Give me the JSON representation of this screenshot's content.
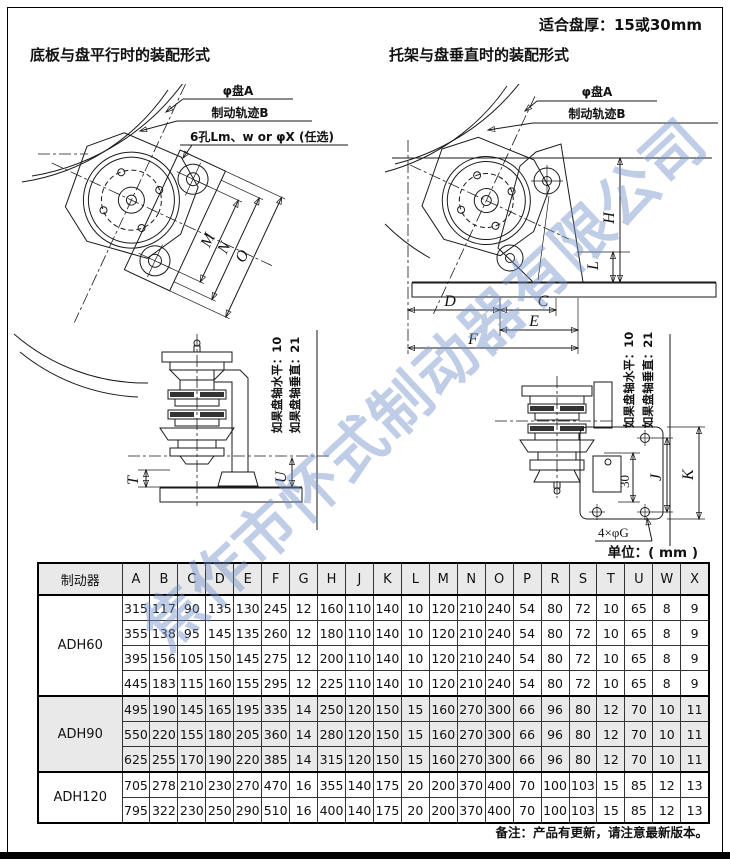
{
  "page": {
    "disc_note": "适合盘厚：15或30mm",
    "watermark": "焦作市怀式制动器有限公司",
    "unit_note": "单位：( mm )",
    "footer_note": "备注：产品有更新，请注意最新版本。"
  },
  "left_section": {
    "title": "底板与盘平行时的装配形式",
    "disc_label": "φ盘A",
    "track_label": "制动轨迹B",
    "holes_label": "6孔Lm、w or φX (任选)",
    "note_line1": "如果盘轴水平：10",
    "note_line2": "如果盘轴垂直：21",
    "dims": {
      "m": "M",
      "n": "N",
      "o": "O",
      "t": "T",
      "u": "U"
    }
  },
  "right_section": {
    "title": "托架与盘垂直时的装配形式",
    "disc_label": "φ盘A",
    "track_label": "制动轨迹B",
    "holes_label": "4×φG",
    "note_line1": "如果盘轴水平：10",
    "note_line2": "如果盘轴垂直：21",
    "dims": {
      "h": "H",
      "l": "L",
      "d": "D",
      "c": "C",
      "e": "E",
      "f": "F",
      "j": "J",
      "k": "K",
      "plate_offset": "30"
    }
  },
  "table": {
    "header": [
      "制动器",
      "A",
      "B",
      "C",
      "D",
      "E",
      "F",
      "G",
      "H",
      "J",
      "K",
      "L",
      "M",
      "N",
      "O",
      "P",
      "R",
      "S",
      "T",
      "U",
      "W",
      "X"
    ],
    "groups": [
      {
        "model": "ADH60",
        "shaded": false,
        "rows": [
          [
            315,
            117,
            90,
            135,
            130,
            245,
            12,
            160,
            110,
            140,
            10,
            120,
            210,
            240,
            54,
            80,
            72,
            10,
            65,
            8,
            9
          ],
          [
            355,
            138,
            95,
            145,
            135,
            260,
            12,
            180,
            110,
            140,
            10,
            120,
            210,
            240,
            54,
            80,
            72,
            10,
            65,
            8,
            9
          ],
          [
            395,
            156,
            105,
            150,
            145,
            275,
            12,
            200,
            110,
            140,
            10,
            120,
            210,
            240,
            54,
            80,
            72,
            10,
            65,
            8,
            9
          ],
          [
            445,
            183,
            115,
            160,
            155,
            295,
            12,
            225,
            110,
            140,
            10,
            120,
            210,
            240,
            54,
            80,
            72,
            10,
            65,
            8,
            9
          ]
        ]
      },
      {
        "model": "ADH90",
        "shaded": true,
        "rows": [
          [
            495,
            190,
            145,
            165,
            195,
            335,
            14,
            250,
            120,
            150,
            15,
            160,
            270,
            300,
            66,
            96,
            80,
            12,
            70,
            10,
            11
          ],
          [
            550,
            220,
            155,
            180,
            205,
            360,
            14,
            280,
            120,
            150,
            15,
            160,
            270,
            300,
            66,
            96,
            80,
            12,
            70,
            10,
            11
          ],
          [
            625,
            255,
            170,
            190,
            220,
            385,
            14,
            315,
            120,
            150,
            15,
            160,
            270,
            300,
            66,
            96,
            80,
            12,
            70,
            10,
            11
          ]
        ]
      },
      {
        "model": "ADH120",
        "shaded": false,
        "rows": [
          [
            705,
            278,
            210,
            230,
            270,
            470,
            16,
            355,
            140,
            175,
            20,
            200,
            370,
            400,
            70,
            100,
            103,
            15,
            85,
            12,
            13
          ],
          [
            795,
            322,
            230,
            250,
            290,
            510,
            16,
            400,
            140,
            175,
            20,
            200,
            370,
            400,
            70,
            100,
            103,
            15,
            85,
            12,
            13
          ]
        ]
      }
    ]
  }
}
